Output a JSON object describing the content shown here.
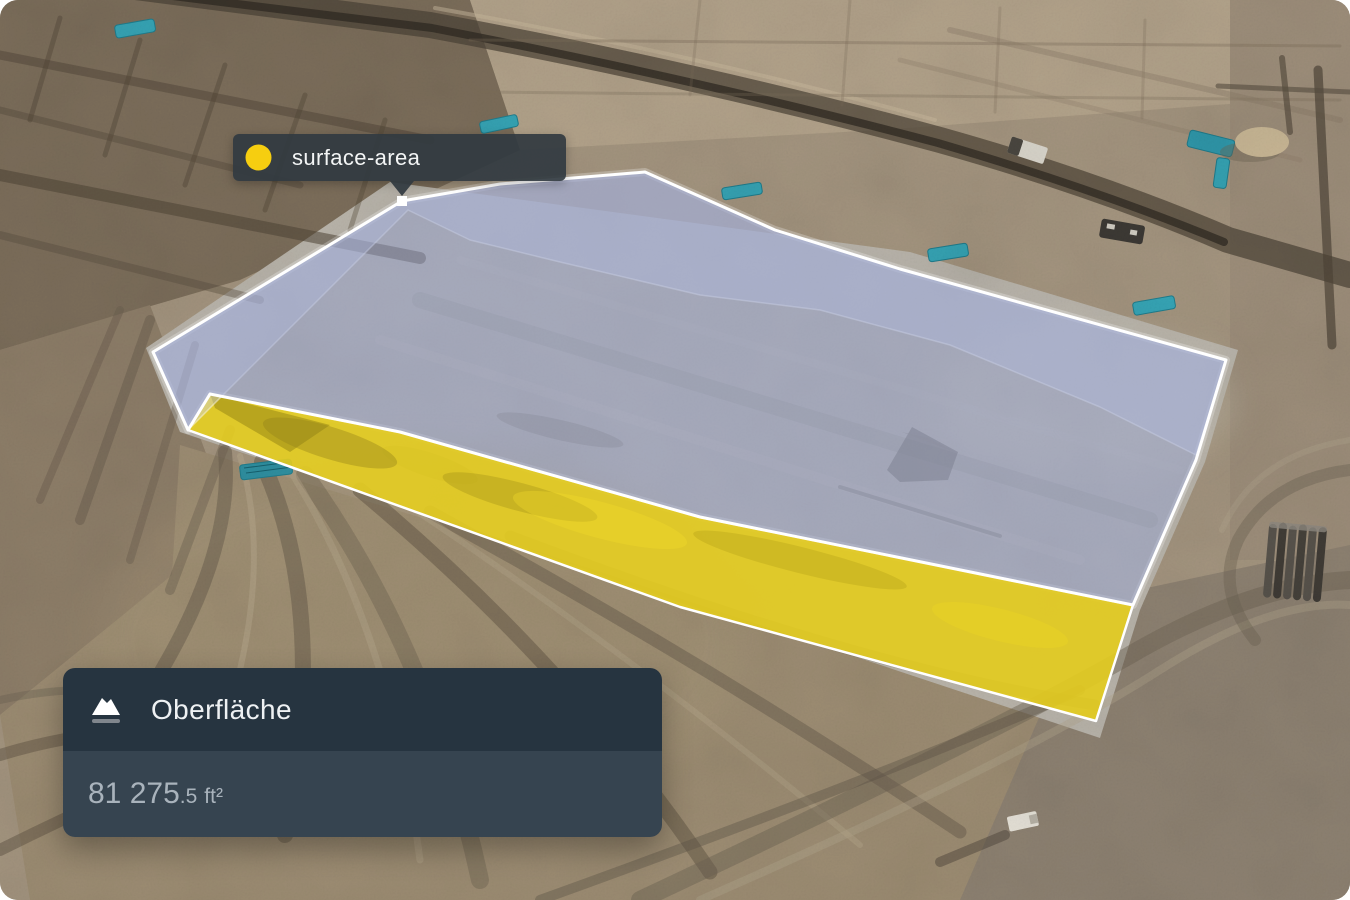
{
  "measurement_tooltip": {
    "label": "surface-area",
    "dot_color": "#F6CE10"
  },
  "measurement_panel": {
    "title": "Oberfläche",
    "area": {
      "value": "81 275",
      "fraction": ".5",
      "unit": "ft²"
    },
    "colors": {
      "header_bg": "#263440",
      "body_bg": "#364450",
      "title_color": "#EEF1F3",
      "value_color": "#A9B3BC"
    }
  },
  "overlay": {
    "surface_color": "#E3CB1F",
    "volume_color": "#93A0CC",
    "band_color": "#CED4F2",
    "edge_color": "#FFFFFF",
    "vertex_color": "#FFFFFF"
  }
}
